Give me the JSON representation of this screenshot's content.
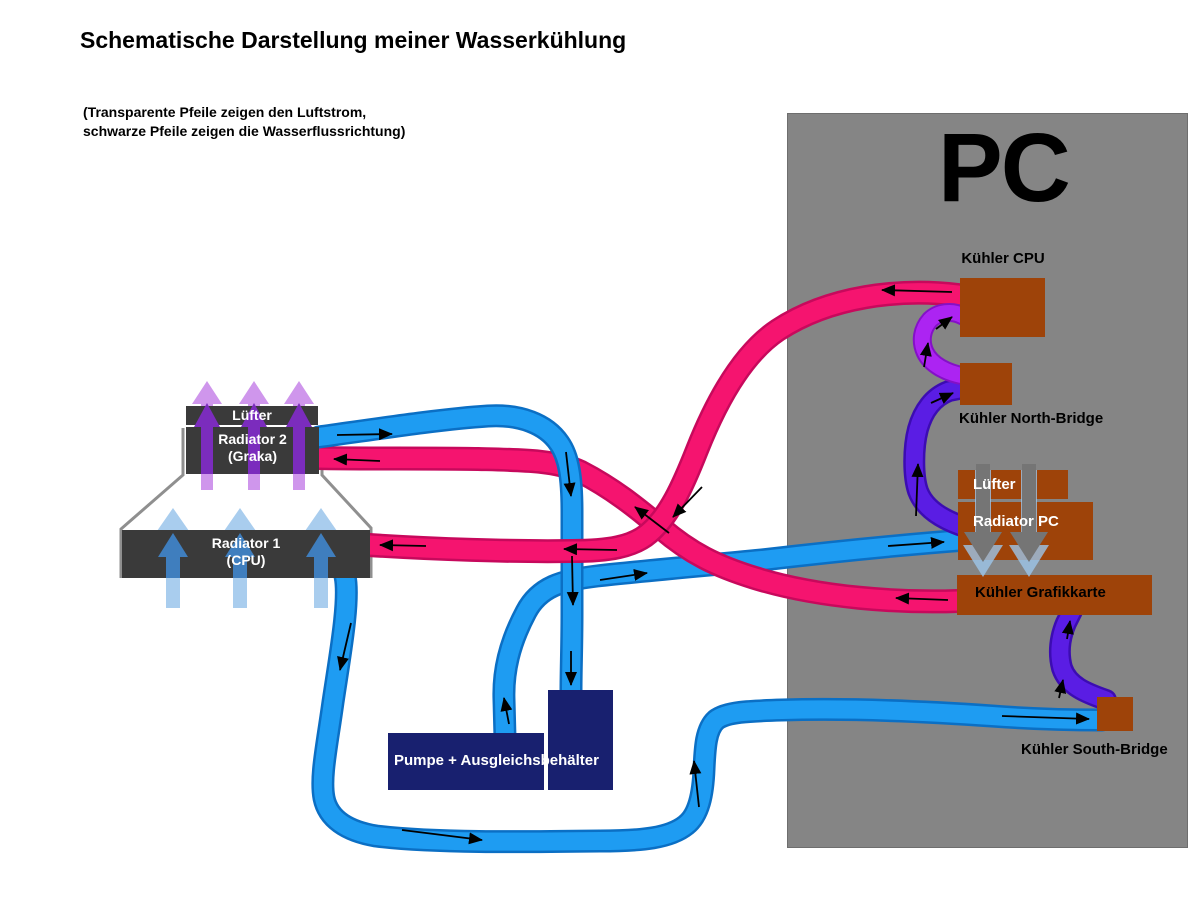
{
  "title": "Schematische Darstellung meiner Wasserkühlung",
  "legend": {
    "line1": "(Transparente Pfeile zeigen den Luftstrom,",
    "line2": "schwarze Pfeile zeigen die Wasserflussrichtung)"
  },
  "pc": {
    "label": "PC"
  },
  "components": {
    "kuehler_cpu": "Kühler CPU",
    "kuehler_north_bridge": "Kühler North-Bridge",
    "luefter_pc": "Lüfter",
    "radiator_pc": "Radiator PC",
    "kuehler_grafikkarte": "Kühler Grafikkarte",
    "kuehler_south_bridge": "Kühler South-Bridge",
    "luefter_links": "Lüfter",
    "radiator2_line1": "Radiator 2",
    "radiator2_line2": "(Graka)",
    "radiator1_line1": "Radiator 1",
    "radiator1_line2": "(CPU)",
    "pumpe": "Pumpe + Ausgleichsbehälter"
  },
  "colors": {
    "pc_case_gray": "#858585",
    "component_brown": "#9e4309",
    "radiator_dark_gray": "#3a3a3a",
    "pump_navy": "#18206f",
    "tube_blue": "#1e9cf2",
    "tube_pink": "#f5146f",
    "tube_violet": "#5a1de4",
    "tube_magenta": "#ac24f2",
    "air_light_purple": "#cf96ec",
    "air_dark_purple": "#7b2cbd",
    "air_light_blue": "#a9cdee",
    "air_steel_blue": "#3f7ebe",
    "air_gray": "#757575",
    "flow_arrow_black": "#000000"
  }
}
